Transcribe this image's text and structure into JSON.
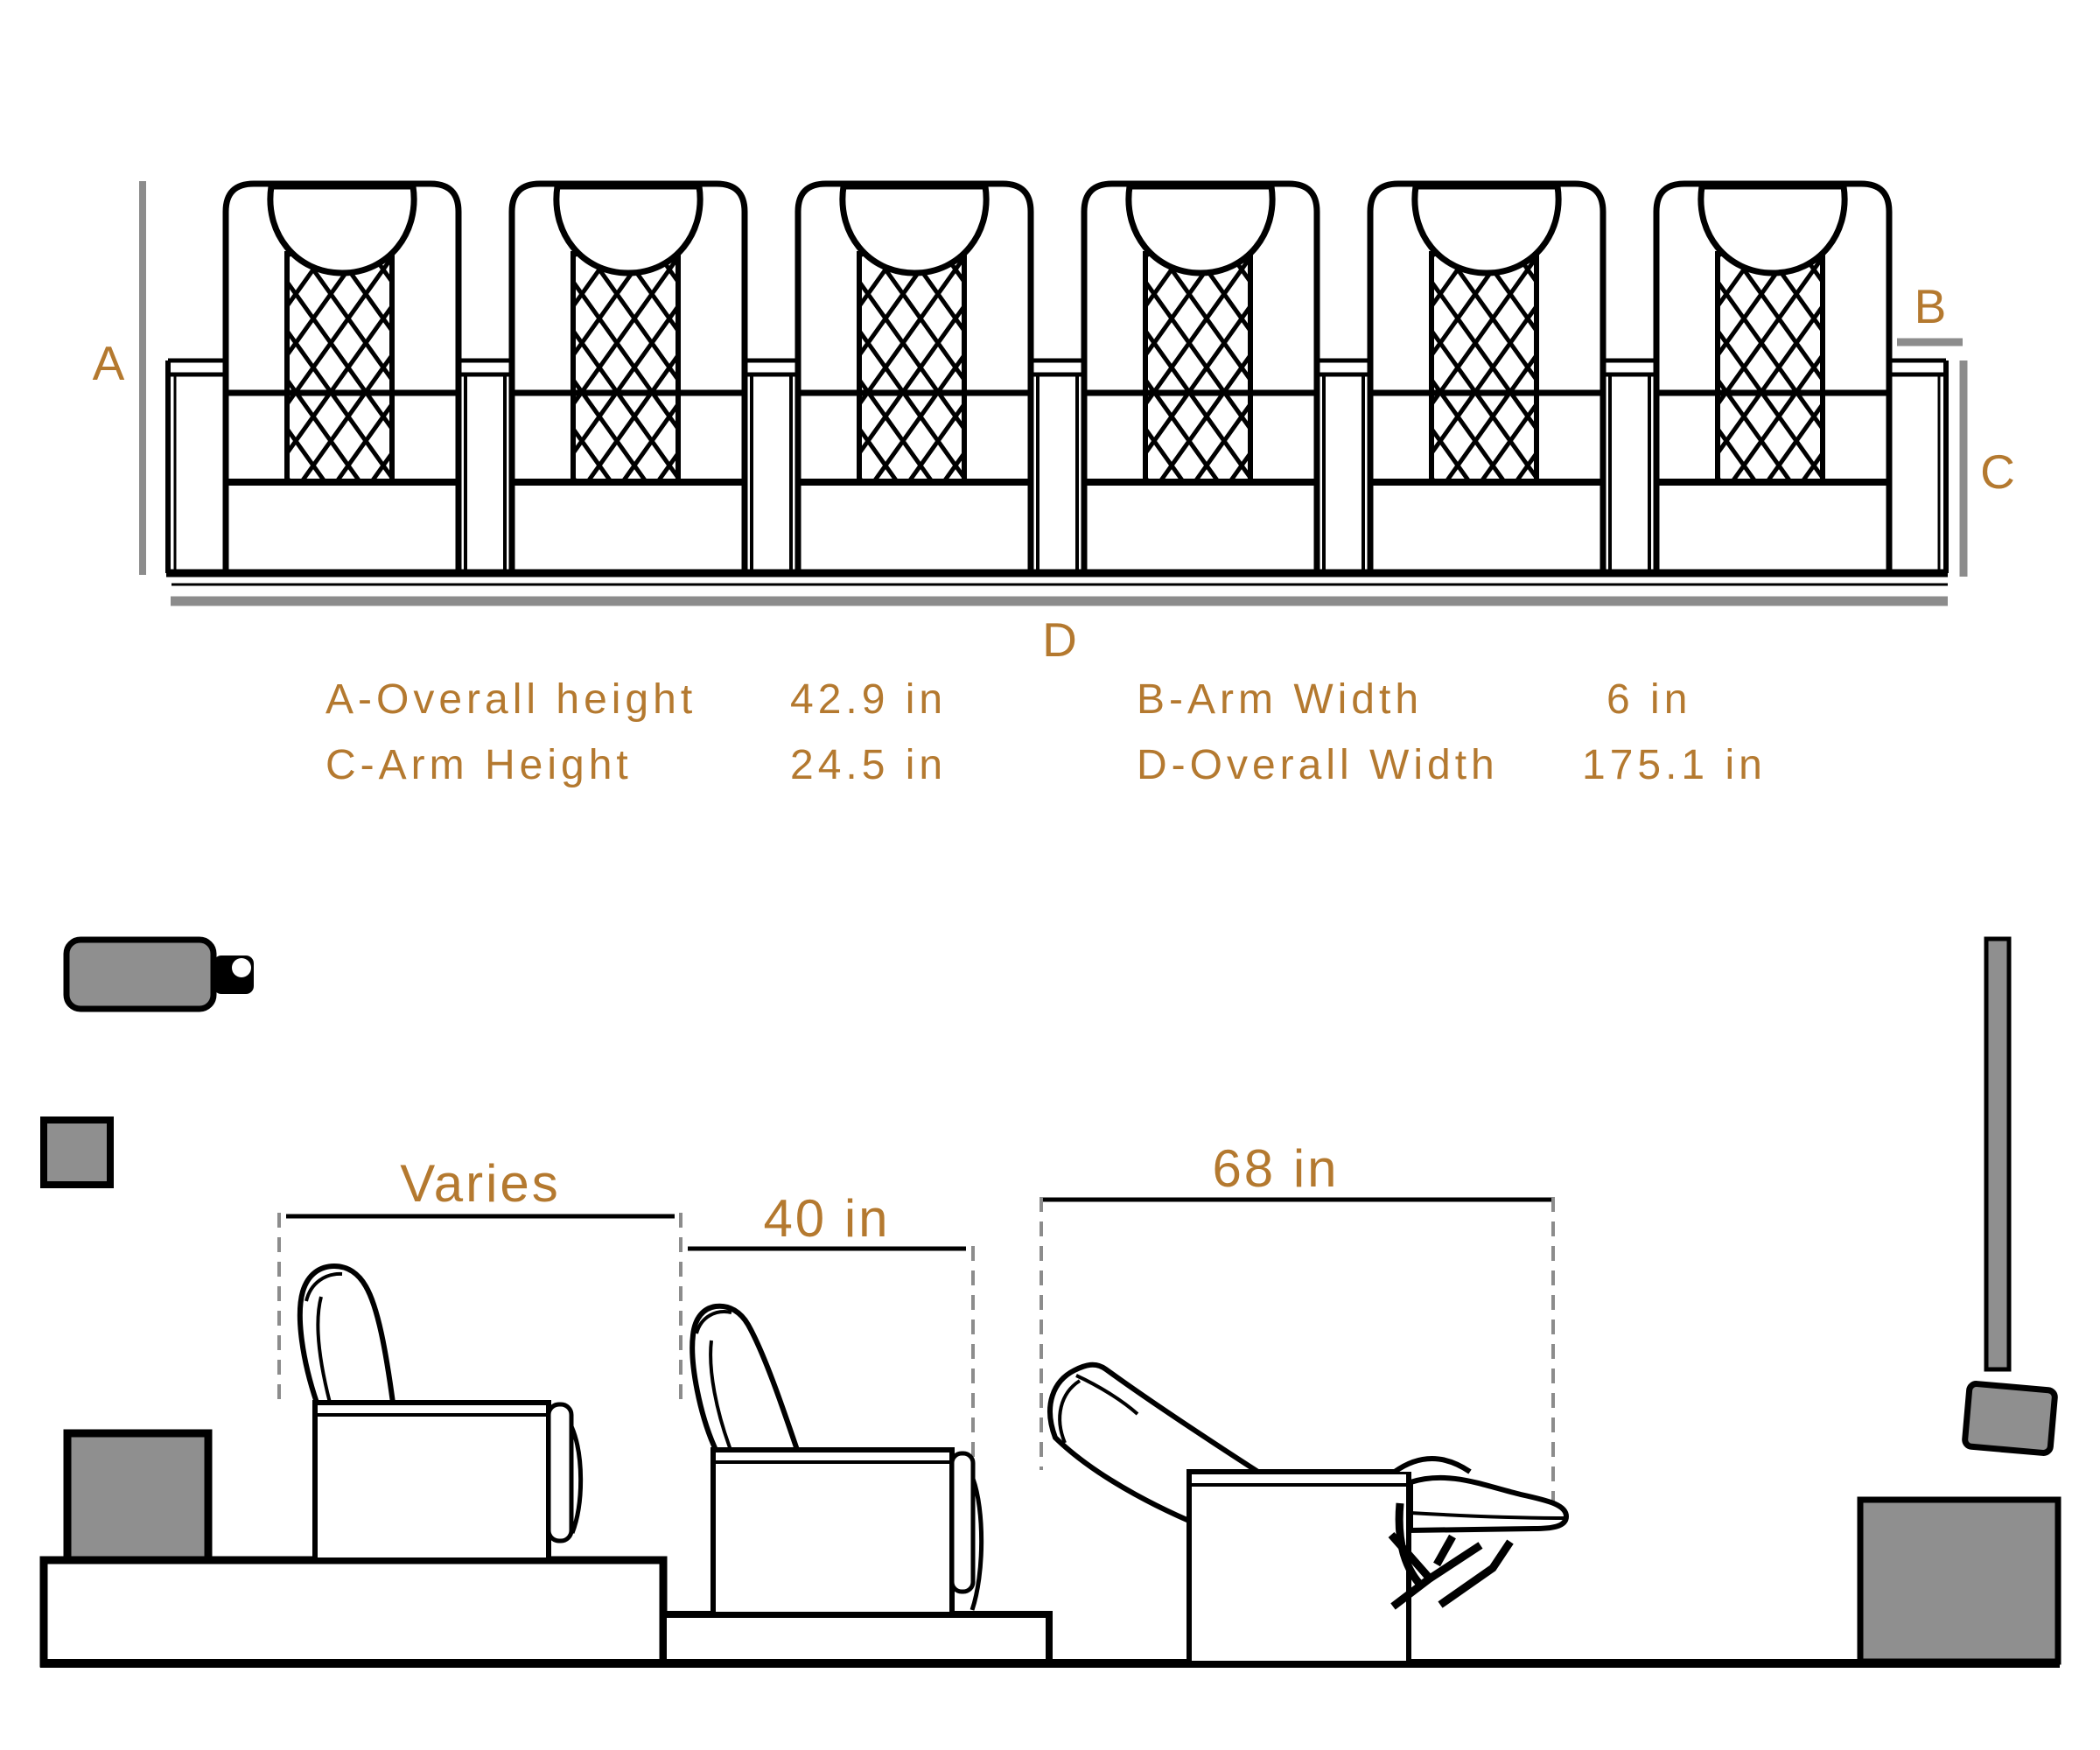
{
  "colors": {
    "accent": "#B4792F",
    "diagram_ink": "#000000",
    "fill_gray": "#8F8F8F",
    "dimension_gray": "#8C8C8C",
    "background": "#FFFFFF"
  },
  "front_view": {
    "seat_count": 6,
    "dim_labels": {
      "a": "A",
      "b": "B",
      "c": "C",
      "d": "D"
    }
  },
  "legend": {
    "a_label": "A-Overall height",
    "a_value": "42.9 in",
    "c_label": "C-Arm Height",
    "c_value": "24.5 in",
    "b_label": "B-Arm Width",
    "b_value": "6 in",
    "d_label": "D-Overall Width",
    "d_value": "175.1 in"
  },
  "side_view": {
    "upright_dim": "Varies",
    "partial_recline_dim": "40 in",
    "full_recline_dim": "68 in"
  }
}
